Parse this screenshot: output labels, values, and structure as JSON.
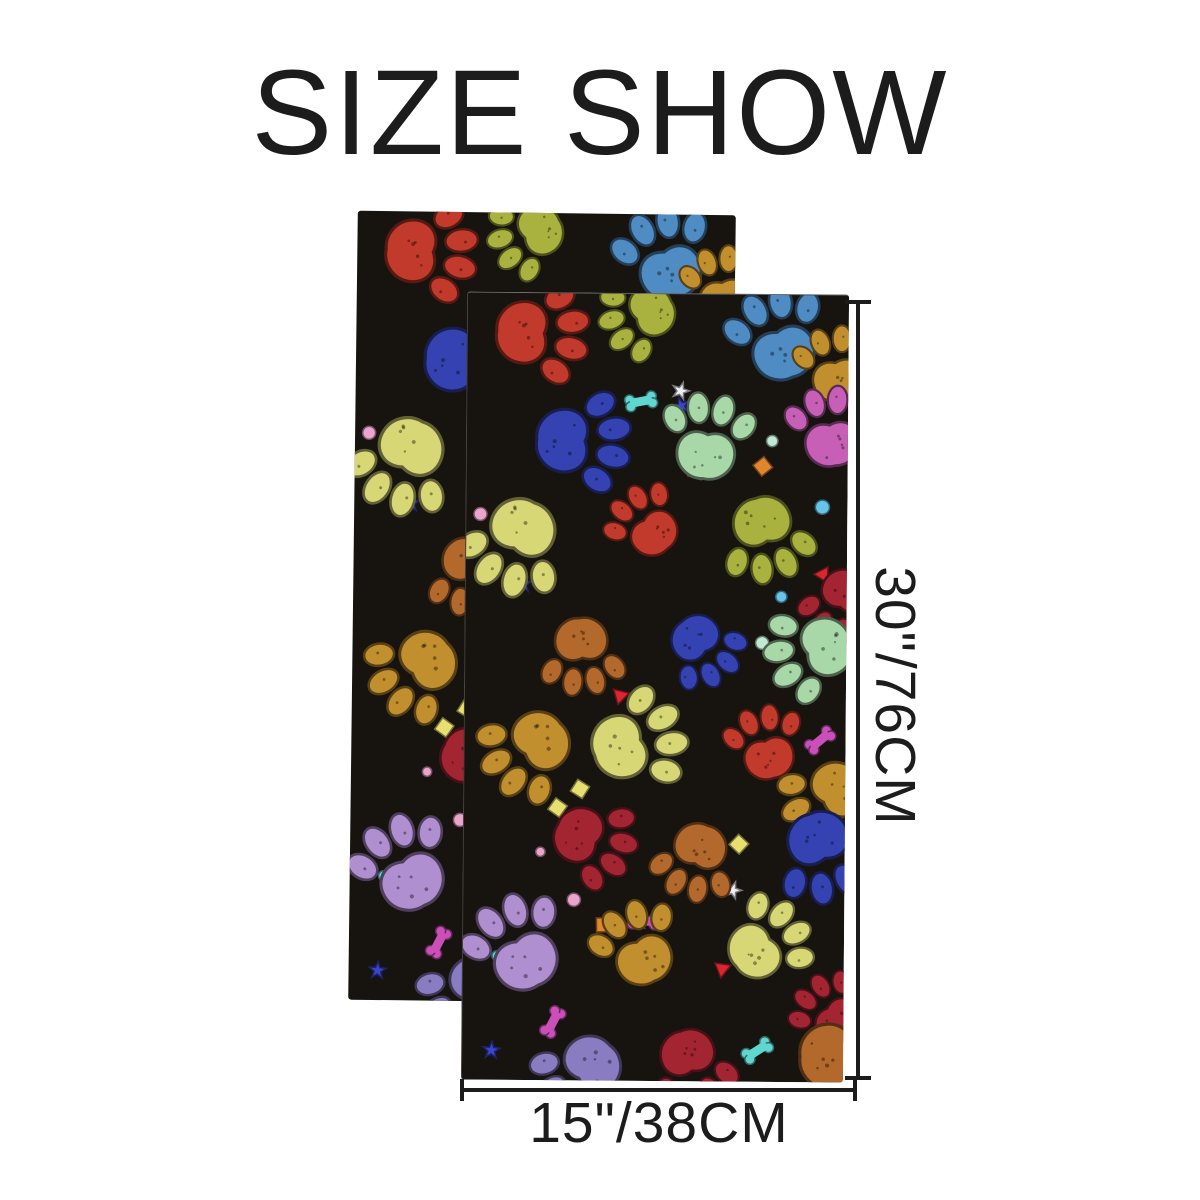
{
  "title": "SIZE SHOW",
  "size_labels": {
    "height": "30\"/76CM",
    "width": "15\"/38CM"
  },
  "towels": {
    "count": 2,
    "fabric_background": "#17130f",
    "paw_colors": [
      "#c23a2b",
      "#3c9c62",
      "#b4692c",
      "#c75fb6",
      "#c28f2f",
      "#a9b23f",
      "#8a7cc0",
      "#3543b2",
      "#3f9e99",
      "#d8d776",
      "#4f8cc4",
      "#a32532",
      "#a8d8a8",
      "#b08fd0"
    ],
    "confetti_colors": [
      "#3945cf",
      "#66c4e8",
      "#e2862e",
      "#d92631",
      "#e7df6f",
      "#eba4cc",
      "#bfe9d2",
      "#cb4fb9",
      "#5fd6cf",
      "#efeff8"
    ],
    "speckle_color": "rgba(0,0,0,0.38)"
  },
  "annotation_color": "#1c1c1c",
  "background_color": "#ffffff"
}
